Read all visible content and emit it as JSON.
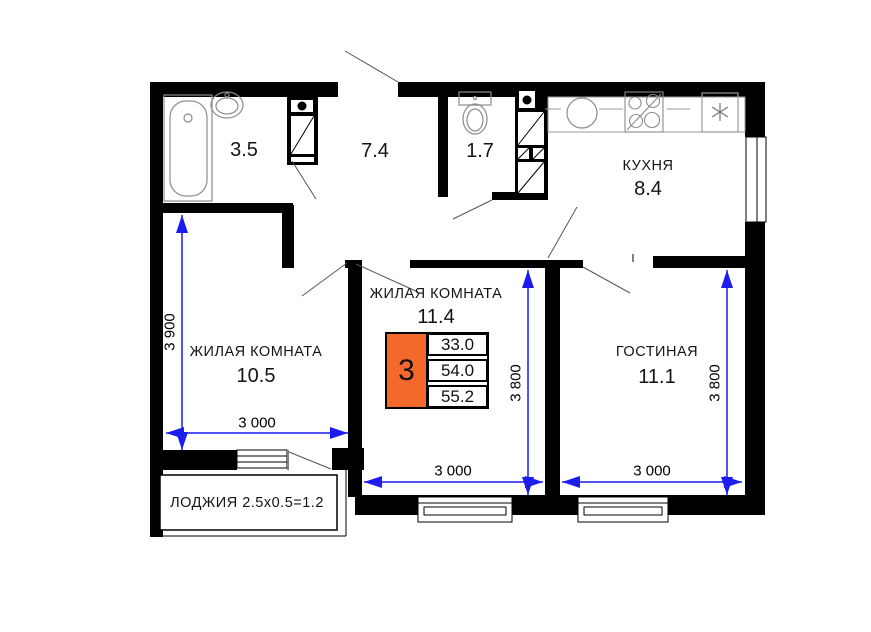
{
  "rooms": {
    "bathroom": {
      "area": "3.5"
    },
    "hallway": {
      "area": "7.4"
    },
    "wc": {
      "area": "1.7"
    },
    "kitchen": {
      "name": "КУХНЯ",
      "area": "8.4"
    },
    "bedroom_center": {
      "name": "ЖИЛАЯ КОМНАТА",
      "area": "11.4"
    },
    "bedroom_left": {
      "name": "ЖИЛАЯ КОМНАТА",
      "area": "10.5"
    },
    "living_room": {
      "name": "ГОСТИНАЯ",
      "area": "11.1"
    },
    "loggia": {
      "name": "ЛОДЖИЯ 2.5x0.5=1.2"
    }
  },
  "info_table": {
    "rooms_count": "3",
    "living_area": "33.0",
    "apartment_area": "54.0",
    "total_area": "55.2"
  },
  "dimensions": {
    "left_room_height": "3 900",
    "left_room_width": "3 000",
    "center_room_height": "3 800",
    "center_room_width": "3 000",
    "right_room_width": "3 000",
    "right_room_height": "3 800"
  },
  "colors": {
    "wall": "#000000",
    "dimension_line": "#1c1cee",
    "table_accent": "#f4682c"
  },
  "icons": {
    "fridge_icon": "asterisk",
    "vent_shaft_icon": "diagonal-hatch",
    "door_swing_icon": "diagonal-line"
  }
}
